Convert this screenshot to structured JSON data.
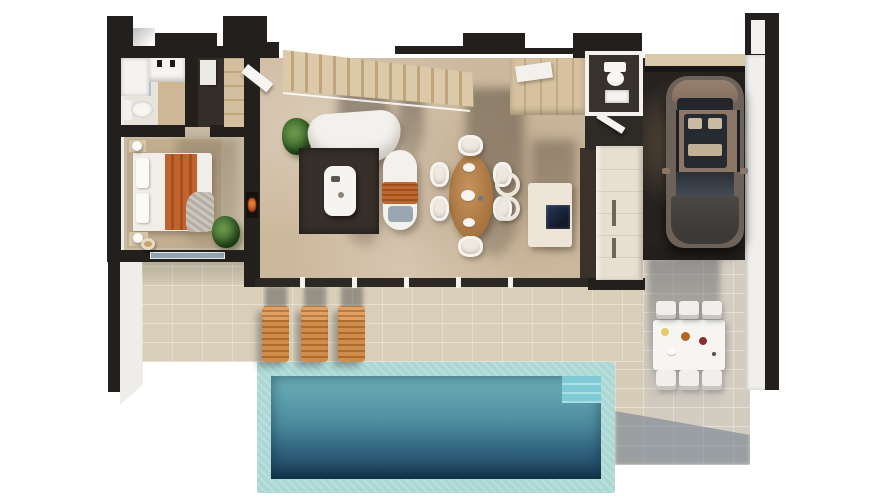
{
  "scene": {
    "description": "3D top-down render of a single-storey villa floor plan with garage, sun terrace and rectangular swimming pool",
    "view": "top-down axonometric",
    "background_color": "#ffffff",
    "width_px": 890,
    "height_px": 500
  },
  "rooms": {
    "bathroom": {
      "label": "En-suite bathroom",
      "fixtures": [
        "walk-in shower",
        "vanity with sink and black taps",
        "toilet"
      ]
    },
    "entry_closet": {
      "label": "Entry hall with wardrobe",
      "fixtures": [
        "tall wardrobe",
        "white shelf unit",
        "open white door"
      ]
    },
    "bedroom": {
      "label": "Bedroom",
      "fixtures": [
        "double bed with white duvet and orange throw",
        "two nightstands with round lamps",
        "beige area rug",
        "potted plant"
      ]
    },
    "living_room": {
      "label": "Living room",
      "fixtures": [
        "curved white sofa",
        "dark brown area rug",
        "white coffee table",
        "white chaise longue with orange towel",
        "wall fireplace",
        "potted plant",
        "timber staircase with glass rail"
      ]
    },
    "dining_area": {
      "label": "Dining area",
      "fixtures": [
        "oval wooden table",
        "six white chairs",
        "white plates"
      ]
    },
    "kitchen": {
      "label": "Kitchen",
      "fixtures": [
        "white island with dark cooktop",
        "two round bar stools",
        "tall beige pantry cabinets",
        "cream counter run with appliances"
      ]
    },
    "wc": {
      "label": "Guest WC",
      "fixtures": [
        "toilet",
        "washbasin"
      ]
    },
    "garage": {
      "label": "Garage",
      "fixtures": [
        "bronze SUV seen from above",
        "dark floor",
        "driveway strip"
      ]
    }
  },
  "outdoor": {
    "terrace": {
      "label": "Sun terrace",
      "loungers_count": 3,
      "items": [
        "3 slatted wooden sun loungers with shadows"
      ]
    },
    "outdoor_dining": {
      "label": "Outdoor dining terrace",
      "chairs_count": 6,
      "items": [
        "white rectangular table with food plates",
        "six white chairs",
        "building shadow"
      ]
    },
    "pool": {
      "label": "Swimming pool",
      "items": [
        "pale aqua deck border",
        "teal water with depth gradient",
        "lighter corner steps"
      ]
    },
    "left_walkway": {
      "label": "Side walkway with garden wall"
    }
  },
  "palette": {
    "walls": "#221f1c",
    "living_floor": "#ccb89c",
    "bedroom_floor": "#c9bba2",
    "terrace_tiles": "#d9cfb8",
    "right_terrace_tiles": "#d3ccc0",
    "pool_deck": "#abd8d5",
    "pool_water_top": "#6fb1b9",
    "pool_water_bottom": "#16344c",
    "lounger_wood": "#d08c4b",
    "dining_wood": "#b5854f",
    "dark_rug": "#37302a",
    "accent_orange": "#c2632d",
    "car_body": "#8d7565",
    "shadow_blue": "#6c7a8c"
  }
}
